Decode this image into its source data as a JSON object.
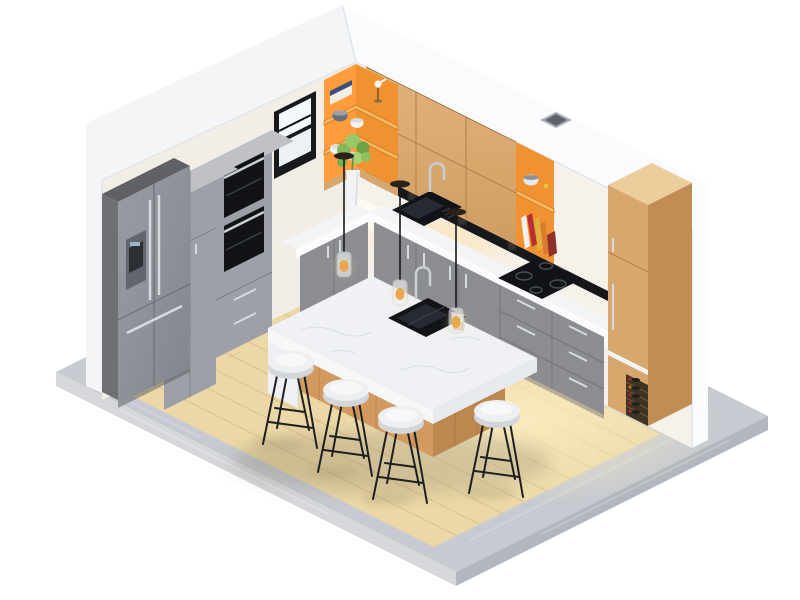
{
  "scene": {
    "title": "Isometric 3D cutaway render of a modern kitchen",
    "style": "low-poly isometric architectural visualization on white background",
    "background": "#ffffff"
  },
  "palette": {
    "background": "#ffffff",
    "platform_top": "#c7cad0",
    "platform_left": "#d5d7da",
    "platform_right": "#b2b6bd",
    "floor_wood": "#ebd8a6",
    "floor_glow": "#f8ebc0",
    "plank_line": "#c9a96f",
    "wall_white_left": "#f3f5f7",
    "wall_white_right": "#fafbfc",
    "wall_interior_left": "#f2ede5",
    "wall_interior_right": "#f6f1e9",
    "backsplash": "#fdfaf4",
    "oak_front": "#d8a76e",
    "oak_side": "#c08d55",
    "oak_top": "#ecce9d",
    "orange_main": "#f0922f",
    "orange_light": "#ff9d3c",
    "orange_shelf_board": "#f9b961",
    "gray_cabinet": "#8b8d92",
    "gray_cabinet_light": "#9da0a6",
    "gray_cabinet_top": "#bfc1c7",
    "fridge_front": "#8f9298",
    "fridge_side": "#6e7075",
    "counter_top": "#f3f4f6",
    "counter_face": "#fafbfc",
    "marble_top": "#eff1f4",
    "island_oak": "#d29a5f",
    "island_oak_dark": "#bd8750",
    "stool_seat": "#edeff1",
    "leg_black": "#1d1f22",
    "black_appliance": "#121318",
    "chrome": "#c9ced4",
    "rail_black": "#17181c",
    "wine_rack": "#3f3322",
    "wine_red": "#a32c2c",
    "vent_gray": "#aab0b8",
    "glass_shade": "#eef2f6",
    "bulb_amber": "#e8a84c",
    "plant_green": "#86b757",
    "vase_white": "#f2f3f4",
    "window_frame": "#17191d"
  },
  "inventory": {
    "appliances": [
      "french-door refrigerator with ice and water dispenser",
      "double wall oven tower",
      "induction cooktop with 4 burners",
      "black undermount counter sink with gooseneck faucet",
      "island prep sink with gooseneck faucet"
    ],
    "cabinetry": [
      "gray flat-front base cabinets with bar handles",
      "gray tall cabinet",
      "oak slab upper cabinets",
      "oak tall pantry cabinet",
      "orange open corner shelf",
      "orange open wall shelf",
      "wine rack with 5 bottles"
    ],
    "furniture_counts": {
      "bar_stools": 4,
      "pendant_lights": 3,
      "kitchen_islands": 1
    },
    "decor": [
      "potted plant in tall white vase",
      "stacked books and bird figurine",
      "ceramic bowls and cups",
      "leaning cookbooks and knife block",
      "glass jar with amber contents"
    ],
    "architecture": [
      "white cutaway walls",
      "black framed double-hung window",
      "ceiling vent",
      "light wood plank floor",
      "concrete plinth base"
    ]
  }
}
